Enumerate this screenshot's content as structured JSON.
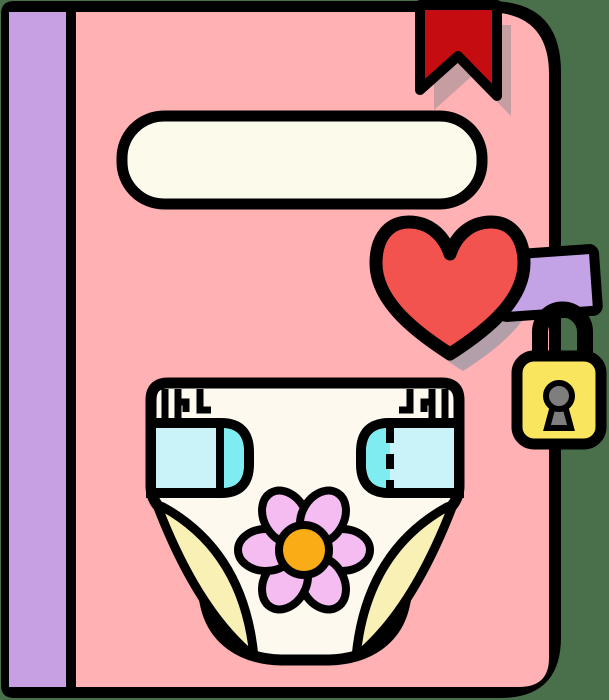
{
  "scene": {
    "description": "Pink locked diary illustration: purple spine, red corner bookmark, blank cream title label, red heart, purple clasp strap with yellow padlock, diaper with flower drawn on the cover",
    "background_color": "#4a6f4b",
    "outline_color": "#000000"
  },
  "book": {
    "spine_color": "#c6a0e2",
    "cover_color": "#ffb1b4",
    "title_label_color": "#fbfaeb",
    "title_label_text": ""
  },
  "bookmark": {
    "color": "#c50d11",
    "shadow_color": "#c69da1"
  },
  "heart": {
    "color": "#f3534e",
    "shadow_color": "#b29fa9"
  },
  "clasp": {
    "strap_color": "#c3a3e6",
    "lock_body_color": "#fae55f",
    "keyhole_color": "#7e7e7e"
  },
  "diaper": {
    "body_color": "#fdf9ef",
    "tab_light_color": "#c9f3f9",
    "tab_accent_color": "#7fecf2",
    "leg_cuff_color": "#f9f0b6"
  },
  "flower": {
    "petal_color": "#f4bcf1",
    "center_color": "#f9ac15"
  }
}
